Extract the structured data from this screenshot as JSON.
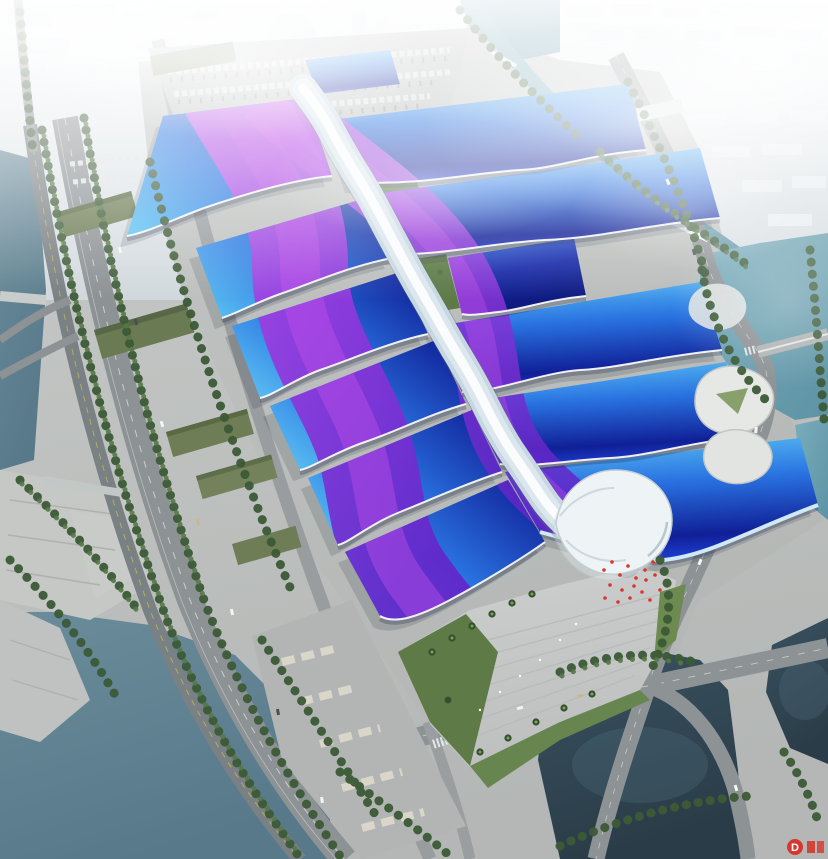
{
  "watermark": {
    "text": "D",
    "color": "#d6372e"
  },
  "palette": {
    "sky_fog_top": "#f3f6f7",
    "city_base": "#ccd4d9",
    "city_front": "#e9eef1",
    "city_side": "#c6d0d6",
    "ground": "#b4b7b5",
    "apron": "#bcbfbd",
    "plaza": "#cdcfce",
    "road": "#8d9295",
    "viaduct": "#7a8184",
    "water_canal": "#79adbc",
    "water_river": "#5d93a4",
    "water_lake": "#57798a",
    "water_pond": "#2a3c48",
    "roof_cyan": "#5cc2f2",
    "roof_mid": "#2a74e2",
    "roof_blue": "#1b39c8",
    "roof_navy": "#101f96",
    "ribbon_light": "#c653ea",
    "ribbon_mid": "#9338dd",
    "ribbon_deep": "#6326c9",
    "spine_white": "#f2f7fa",
    "spine_shade": "#c7d8e3",
    "tree_dark": "#3c5a36",
    "tree_light": "#587748",
    "lawn": "#6d8a50",
    "olive_roof": "#6e7d55",
    "flag_red": "#d6372e"
  }
}
